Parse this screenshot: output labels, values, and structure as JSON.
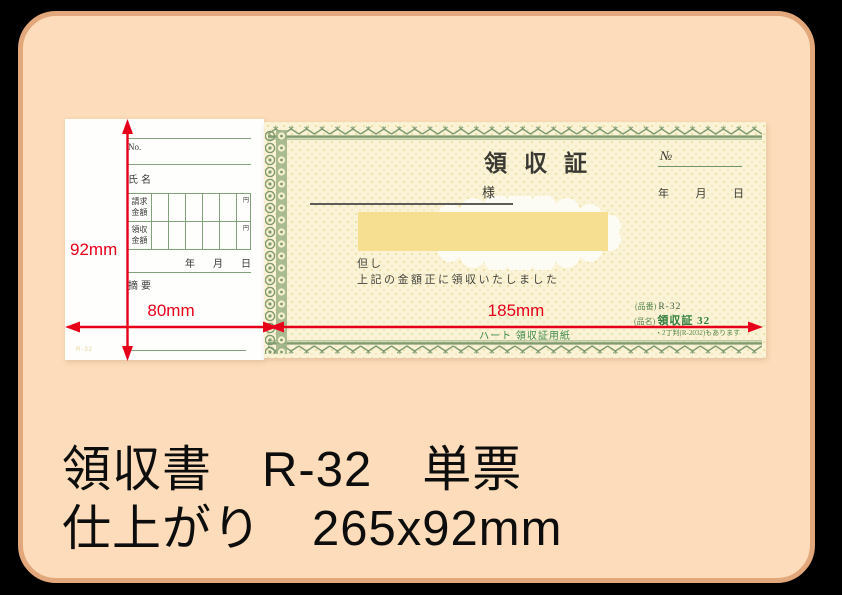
{
  "colors": {
    "page_bg": "#000000",
    "frame_fill": "#fcdcba",
    "frame_border": "#e2a87c",
    "accent_red": "#e60019",
    "form_green": "#7e9a6f",
    "product_green": "#2e7d3c",
    "highlight_yellow": "#f5de8c",
    "receipt_cream": "#faf3d7"
  },
  "caption": {
    "line1": "領収書　R-32　単票",
    "line2": "仕上がり　265x92mm"
  },
  "dimensions": {
    "height": "92mm",
    "stub_width": "80mm",
    "body_width": "185mm"
  },
  "stub": {
    "no_label": "No.",
    "name_label": "氏名",
    "table": {
      "rows": [
        {
          "label": "請求金額",
          "unit": "円"
        },
        {
          "label": "領収金額",
          "unit": "円"
        }
      ]
    },
    "date": {
      "year": "年",
      "month": "月",
      "day": "日"
    },
    "memo_label": "摘要",
    "corner_code": "R-32"
  },
  "receipt": {
    "title": "領収証",
    "no_symbol": "№",
    "addressee_suffix": "様",
    "date": {
      "year": "年",
      "month": "月",
      "day": "日"
    },
    "proviso_label": "但し",
    "statement": "上記の金額正に領収いたしました",
    "brand_line": "ハート 領収証用紙",
    "product_number_label": "(品番)",
    "product_number": "R-32",
    "product_name_label": "(品名)",
    "product_name": "領収証 32",
    "note": "・2丁判(R-2032)もあります"
  }
}
